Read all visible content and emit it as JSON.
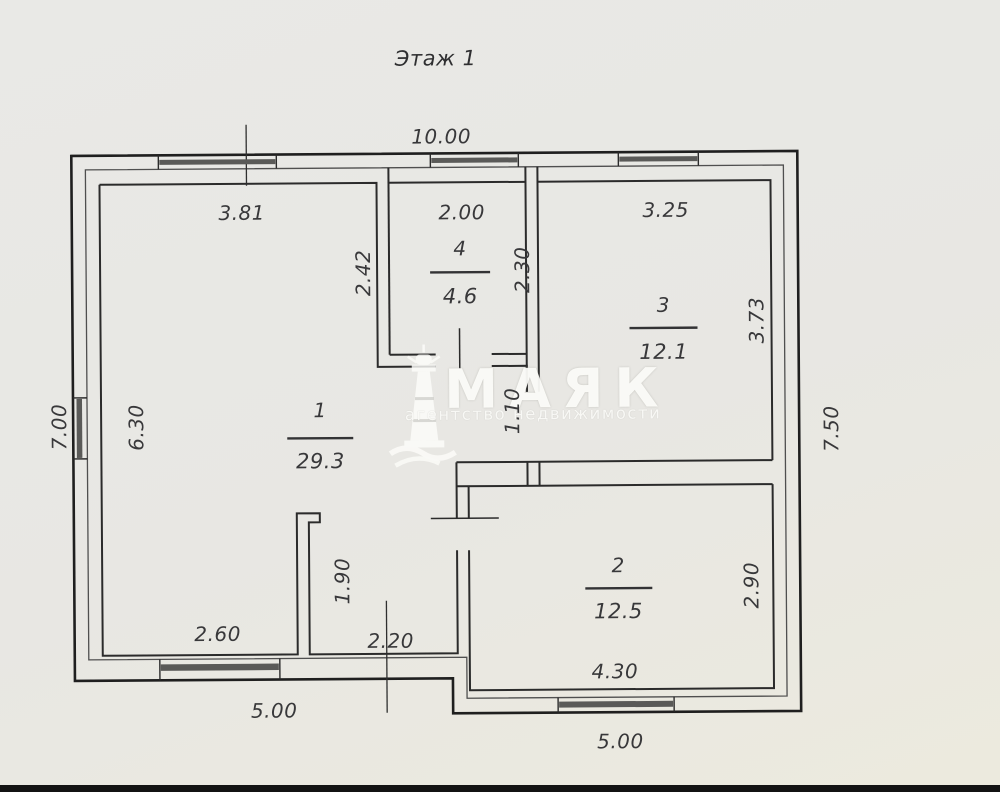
{
  "page": {
    "title": "Этаж 1"
  },
  "watermark": {
    "name": "МАЯК",
    "subtitle": "агентство недвижимости"
  },
  "rooms": [
    {
      "number": "1",
      "area": "29.3"
    },
    {
      "number": "2",
      "area": "12.5"
    },
    {
      "number": "3",
      "area": "12.1"
    },
    {
      "number": "4",
      "area": "4.6"
    }
  ],
  "dimensions": {
    "overall_width_top": "10.00",
    "room1_top": "3.81",
    "room4_top": "2.00",
    "room3_top": "3.25",
    "room4_left": "2.42",
    "room4_right": "2.30",
    "room3_right": "3.73",
    "left_outer": "7.00",
    "room1_left": "6.30",
    "right_outer": "7.50",
    "door_room3": "1.10",
    "partition": "1.90",
    "room2_right": "2.90",
    "room1_bottom_left": "2.60",
    "room1_bottom_right": "2.20",
    "bottom_left_outer": "5.00",
    "room2_bottom": "4.30",
    "bottom_right_outer": "5.00"
  }
}
